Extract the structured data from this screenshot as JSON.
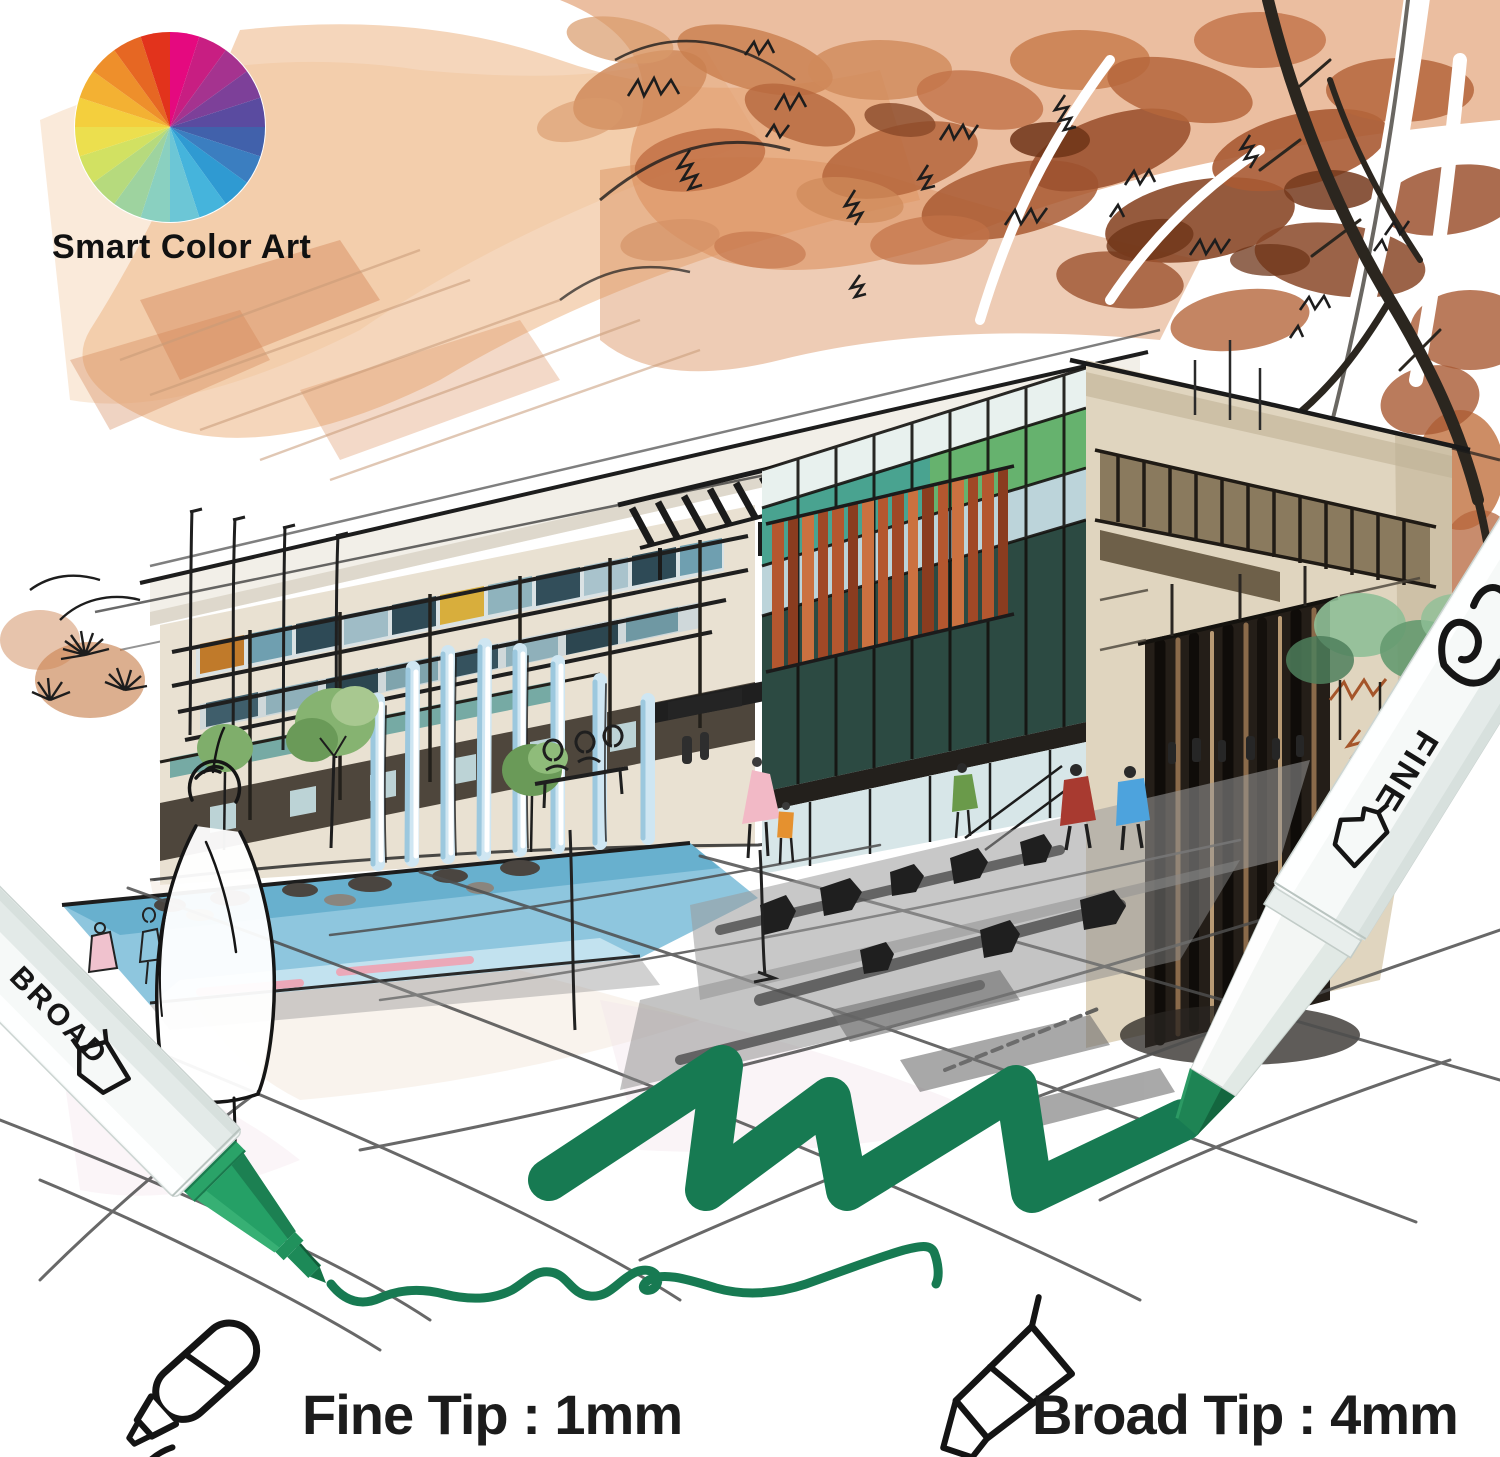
{
  "page": {
    "width": 1500,
    "height": 1457,
    "background": "#ffffff"
  },
  "logo": {
    "brand": "Smart Color Art",
    "wheel_colors": [
      "#e5097f",
      "#c81e82",
      "#a5338f",
      "#7d4099",
      "#5a4ba0",
      "#4161ab",
      "#3b7ec0",
      "#2f9ad2",
      "#45b4dc",
      "#6cc6d6",
      "#8ad0c0",
      "#9ed39f",
      "#b6da7d",
      "#d2e162",
      "#ecdf4e",
      "#f4cf3d",
      "#f3b133",
      "#ee8f2b",
      "#e66723",
      "#e2331c"
    ]
  },
  "artwork": {
    "type": "architectural marker sketch",
    "subject": "modern building with plaza, fountain, autumn trees and people",
    "palette": {
      "sky_wash": "#eebb8d",
      "foliage": "#b5663c",
      "facade_beige": "#e9e1d2",
      "glass_teal": "#49a390",
      "louver_rust": "#b4572f",
      "water_blue": "#8ec6de",
      "shadow_gray": "#8d8d8d",
      "ink_black": "#1d1d1d"
    }
  },
  "pens": {
    "ink_color": "#177a52",
    "left": {
      "label": "BROAD"
    },
    "right": {
      "label": "FINE"
    }
  },
  "specs": {
    "fine": {
      "label": "Fine Tip : 1mm"
    },
    "broad": {
      "label": "Broad Tip : 4mm"
    }
  }
}
